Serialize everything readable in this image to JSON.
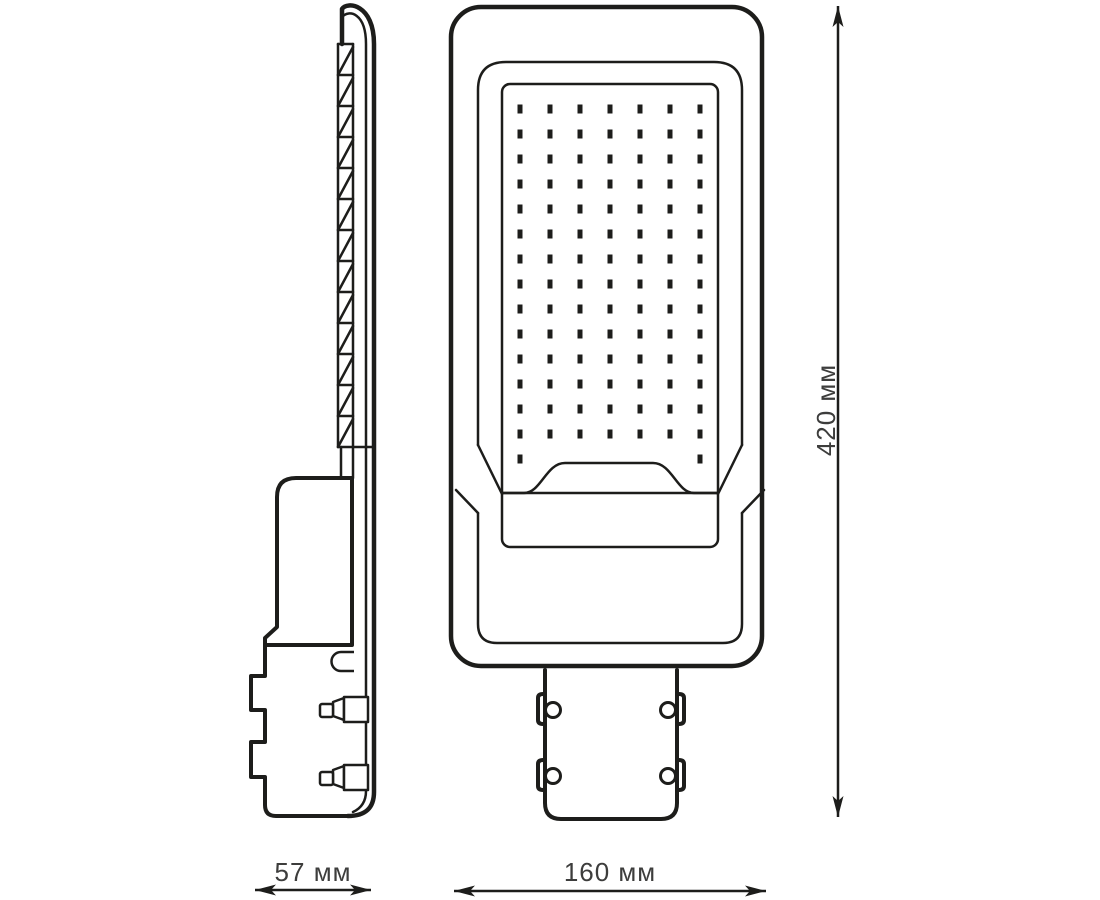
{
  "drawing": {
    "colors": {
      "line": "#1d1d1b",
      "text": "#3d3d3c",
      "background": "#ffffff"
    },
    "side_view": {
      "name": "side profile view",
      "fin_count": 13,
      "bolt_count": 2
    },
    "front_view": {
      "name": "front view",
      "led_grid": {
        "columns": 7,
        "rows": 15,
        "last_row_columns": [
          1,
          7
        ],
        "total_leds": 100
      },
      "bolt_hole_count": 4
    },
    "dimensions": {
      "side_width": {
        "label": "57 мм"
      },
      "front_width": {
        "label": "160 мм"
      },
      "height": {
        "label": "420 мм"
      }
    }
  }
}
